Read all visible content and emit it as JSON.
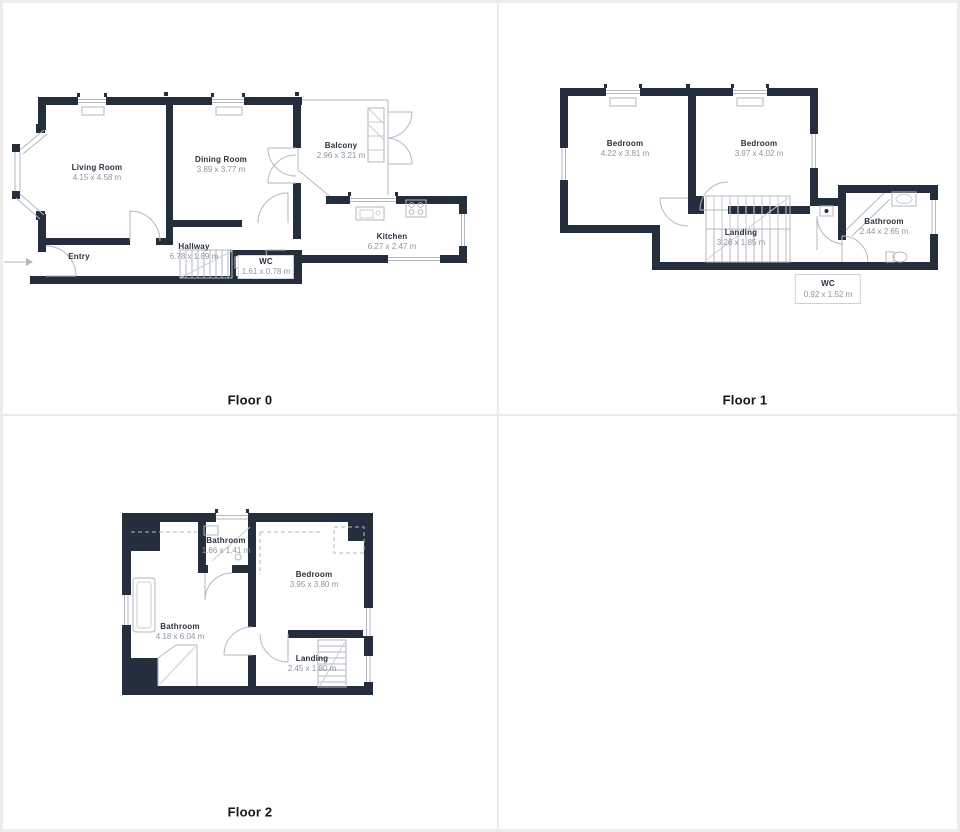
{
  "title": "Floor plans",
  "colors": {
    "wall": "#242e3c",
    "thin_line": "#b2b8c0",
    "dimension_text": "#8e959d",
    "room_text": "#2a323e",
    "grid_divider": "#ececec"
  },
  "floors": [
    {
      "label": "Floor 0",
      "rooms": [
        {
          "name": "Living Room",
          "dims": "4.15 x 4.58 m"
        },
        {
          "name": "Dining Room",
          "dims": "3.89 x 3.77 m"
        },
        {
          "name": "Balcony",
          "dims": "2.96 x 3.21 m"
        },
        {
          "name": "Kitchen",
          "dims": "6.27 x 2.47 m"
        },
        {
          "name": "Hallway",
          "dims": "6.78 x 1.89 m"
        },
        {
          "name": "Entry",
          "dims": ""
        },
        {
          "name": "WC",
          "dims": "1.61 x 0.78 m"
        }
      ]
    },
    {
      "label": "Floor 1",
      "rooms": [
        {
          "name": "Bedroom",
          "dims": "4.22 x 3.81 m"
        },
        {
          "name": "Bedroom",
          "dims": "3.97 x 4.02 m"
        },
        {
          "name": "Landing",
          "dims": "3.26 x 1.85 m"
        },
        {
          "name": "Bathroom",
          "dims": "2.44 x 2.65 m"
        },
        {
          "name": "WC",
          "dims": "0.92 x 1.52 m"
        }
      ]
    },
    {
      "label": "Floor 2",
      "rooms": [
        {
          "name": "Bathroom",
          "dims": "1.66 x 1.41 m"
        },
        {
          "name": "Bedroom",
          "dims": "3.95 x 3.80 m"
        },
        {
          "name": "Bathroom",
          "dims": "4.18 x 6.04 m"
        },
        {
          "name": "Landing",
          "dims": "2.45 x 1.80 m"
        }
      ]
    }
  ]
}
